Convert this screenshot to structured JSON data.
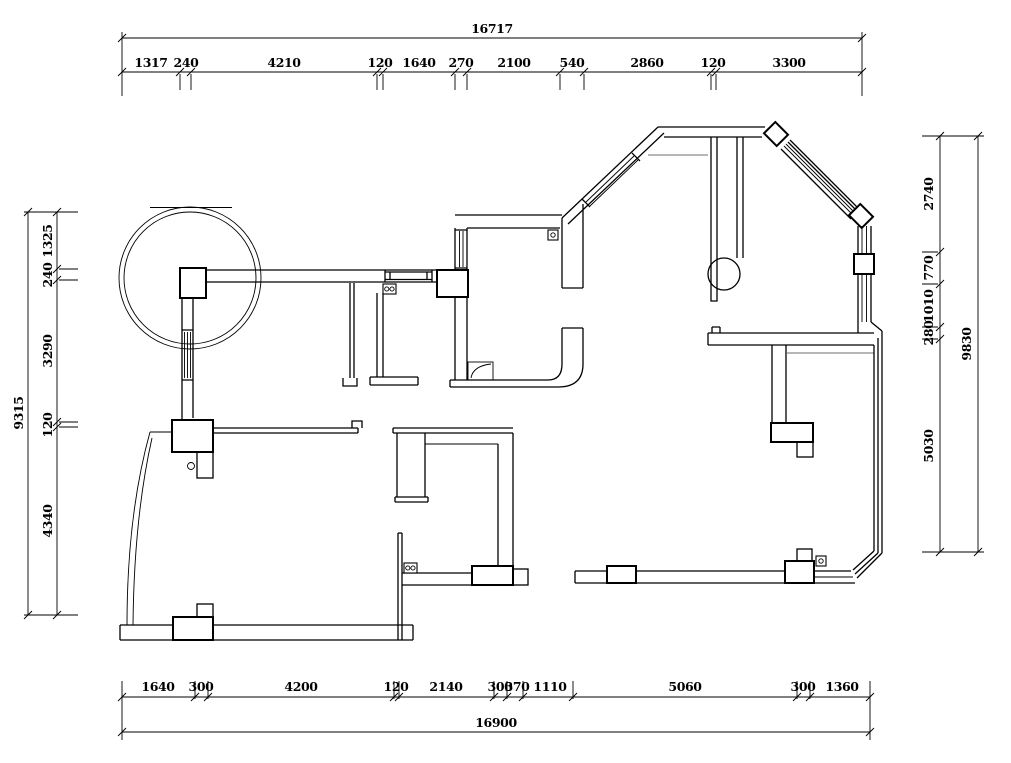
{
  "drawing": {
    "kind": "architectural floor plan (wall / dimension layout)",
    "colors": {
      "background": "#ffffff",
      "line": "#000000",
      "interior_thin_line": "#6e6e6e"
    }
  },
  "dimensions": {
    "top": {
      "total": "16717",
      "segments": [
        "1317",
        "240",
        "4210",
        "120",
        "1640",
        "270",
        "2100",
        "540",
        "2860",
        "120",
        "3300"
      ]
    },
    "bottom": {
      "total": "16900",
      "segments": [
        "1640",
        "300",
        "4200",
        "120",
        "2140",
        "300",
        "370",
        "1110",
        "5060",
        "300",
        "1360"
      ]
    },
    "left": {
      "total": "9315",
      "segments": [
        "1325",
        "240",
        "3290",
        "120",
        "4340"
      ]
    },
    "right": {
      "total": "9830",
      "segments": [
        "2740",
        "770",
        "1010",
        "280",
        "5030"
      ]
    }
  }
}
